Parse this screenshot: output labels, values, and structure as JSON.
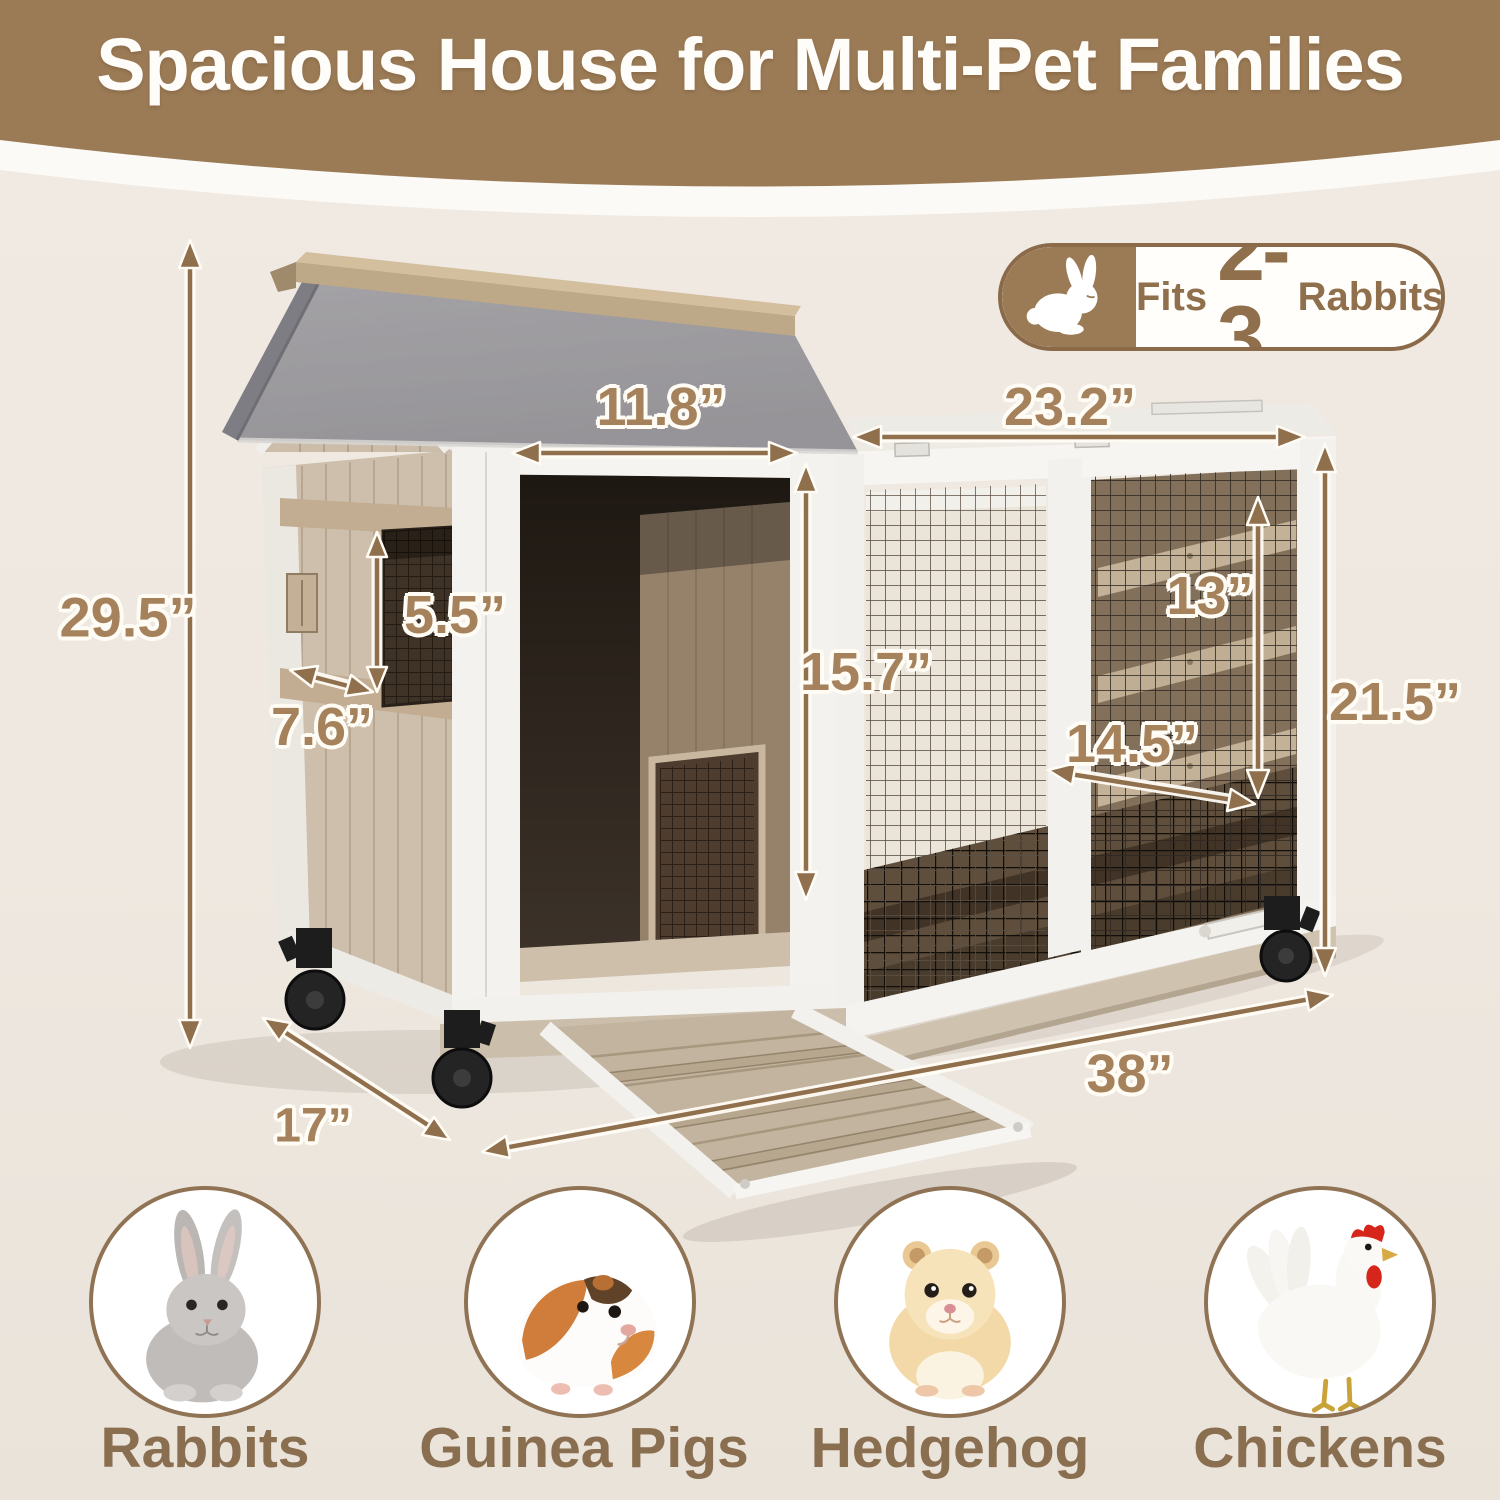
{
  "header": {
    "title": "Spacious House for Multi-Pet Families"
  },
  "badge": {
    "icon": "rabbit-icon",
    "fits_label": "Fits",
    "capacity": "2-3",
    "unit_label": "Rabbits"
  },
  "dimensions": {
    "overall_height": "29.5”",
    "window_height": "5.5”",
    "window_width": "7.6”",
    "door_width": "11.8”",
    "door_height": "15.7”",
    "run_width": "23.2”",
    "interior_height": "13”",
    "run_depth": "14.5”",
    "run_height": "21.5”",
    "base_depth": "17”",
    "overall_width": "38”"
  },
  "animals": [
    {
      "label": "Rabbits",
      "icon": "rabbit-photo-icon"
    },
    {
      "label": "Guinea Pigs",
      "icon": "guinea-pig-photo-icon"
    },
    {
      "label": "Hedgehog",
      "icon": "hamster-photo-icon"
    },
    {
      "label": "Chickens",
      "icon": "chicken-photo-icon"
    }
  ],
  "colors": {
    "banner_brown": "#9b7b56",
    "dimension_text": "#a5825c",
    "label_brown": "#8a6e50",
    "background": "#eee8e0",
    "roof_gray": "#98979c",
    "wood_beige": "#cdbfac",
    "frame_white": "#f4f3f0"
  }
}
